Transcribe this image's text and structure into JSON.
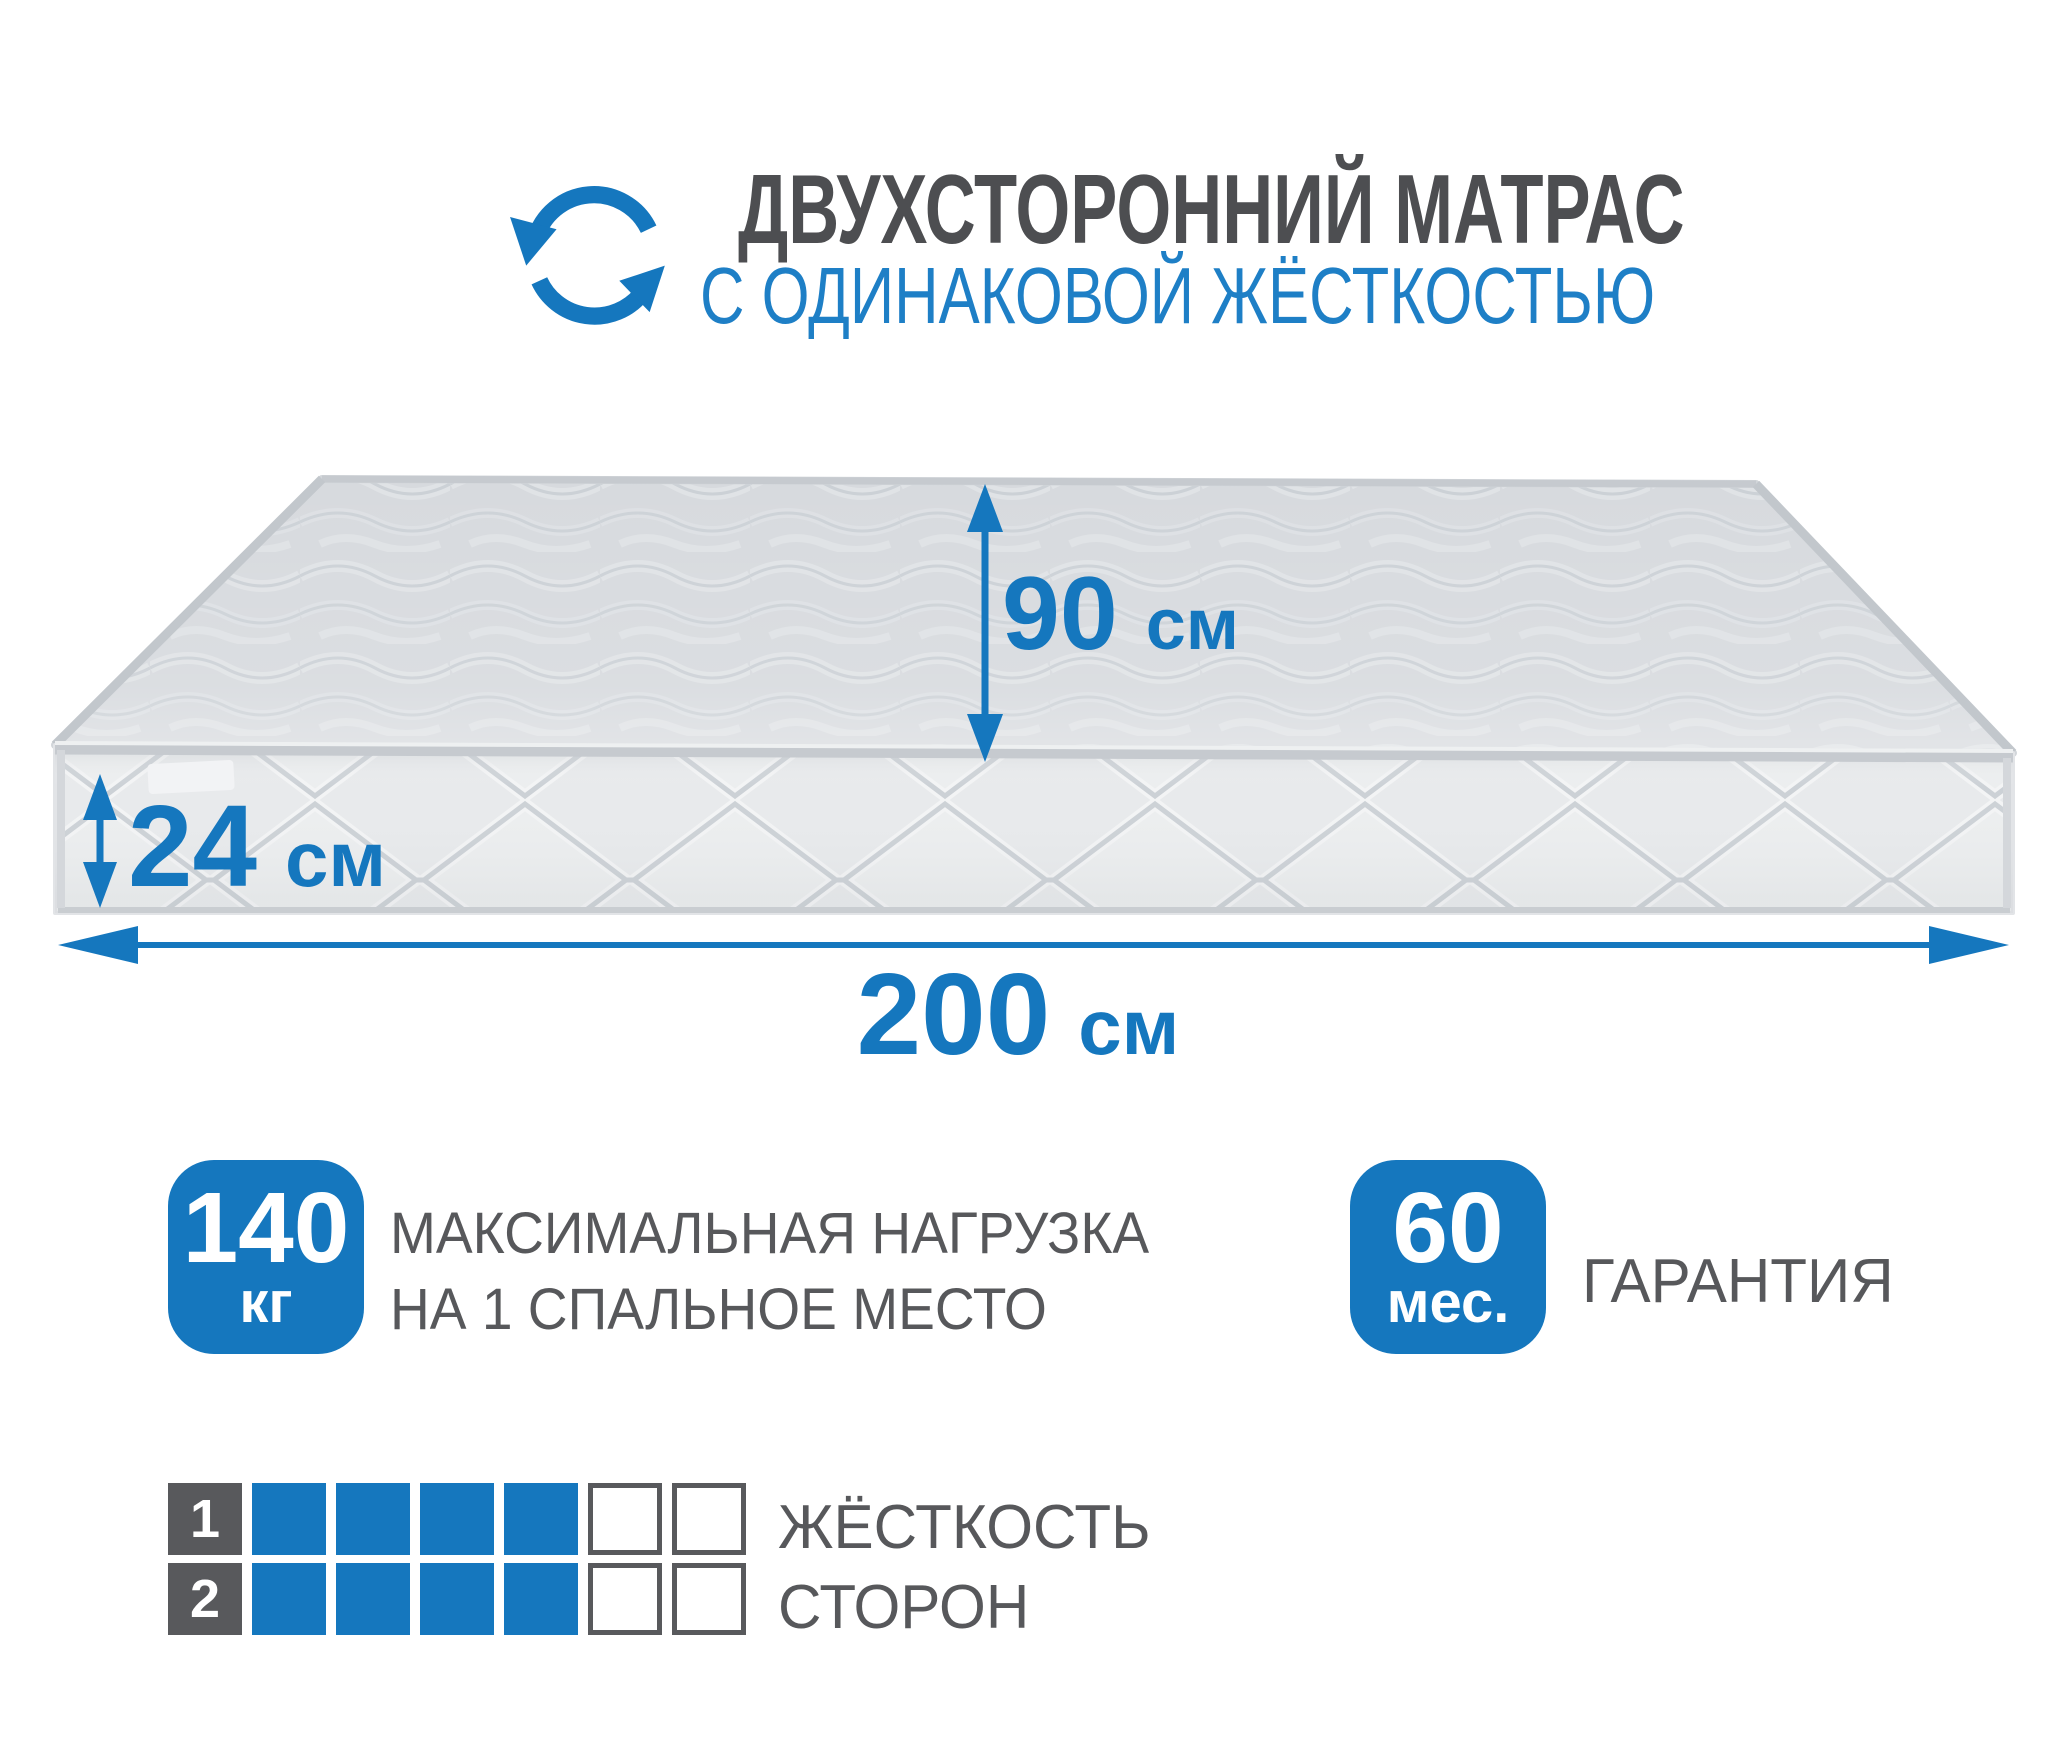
{
  "colors": {
    "accent_blue": "#1577be",
    "title_blue": "#1e7fc6",
    "text_gray": "#57585b",
    "title_gray": "#4d4e51"
  },
  "header": {
    "icon": "circular-rotation-arrows",
    "title_line1": "ДВУХСТОРОННИЙ МАТРАС",
    "title_line2": "С ОДИНАКОВОЙ ЖЁСТКОСТЬЮ"
  },
  "dimensions": {
    "width": {
      "value": "90",
      "unit": "см"
    },
    "thickness": {
      "value": "24",
      "unit": "см"
    },
    "length": {
      "value": "200",
      "unit": "см"
    }
  },
  "badges": {
    "max_load": {
      "value": "140",
      "unit": "кг",
      "label_line1": "МАКСИМАЛЬНАЯ НАГРУЗКА",
      "label_line2": "НА 1 СПАЛЬНОЕ МЕСТО"
    },
    "warranty": {
      "value": "60",
      "unit": "мес.",
      "label": "ГАРАНТИЯ"
    }
  },
  "hardness_scale": {
    "rows": [
      {
        "number": "1",
        "filled": 4,
        "total": 6
      },
      {
        "number": "2",
        "filled": 4,
        "total": 6
      }
    ],
    "label_line1": "ЖЁСТКОСТЬ",
    "label_line2": "СТОРОН"
  }
}
